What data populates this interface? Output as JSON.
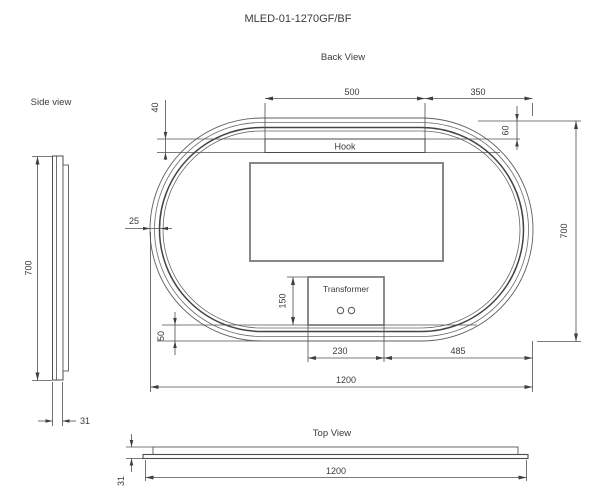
{
  "title": "MLED-01-1270GF/BF",
  "back_view": {
    "label": "Back View",
    "hook_label": "Hook",
    "transformer_label": "Transformer",
    "dims": {
      "hook_width": "500",
      "hook_to_right_edge": "350",
      "hook_height": "40",
      "top_edge_to_hook": "60",
      "frame_inset": "25",
      "overall_height": "700",
      "transformer_height": "150",
      "bottom_frame_inset": "50",
      "transformer_width": "230",
      "transformer_to_right_edge": "485",
      "overall_width": "1200"
    }
  },
  "side_view": {
    "label": "Side view",
    "dims": {
      "height": "700",
      "thickness": "31"
    }
  },
  "top_view": {
    "label": "Top View",
    "dims": {
      "width": "1200",
      "thickness": "31"
    }
  },
  "colors": {
    "line": "#4f4f4f",
    "text": "#3b3b3b",
    "background": "#ffffff"
  }
}
